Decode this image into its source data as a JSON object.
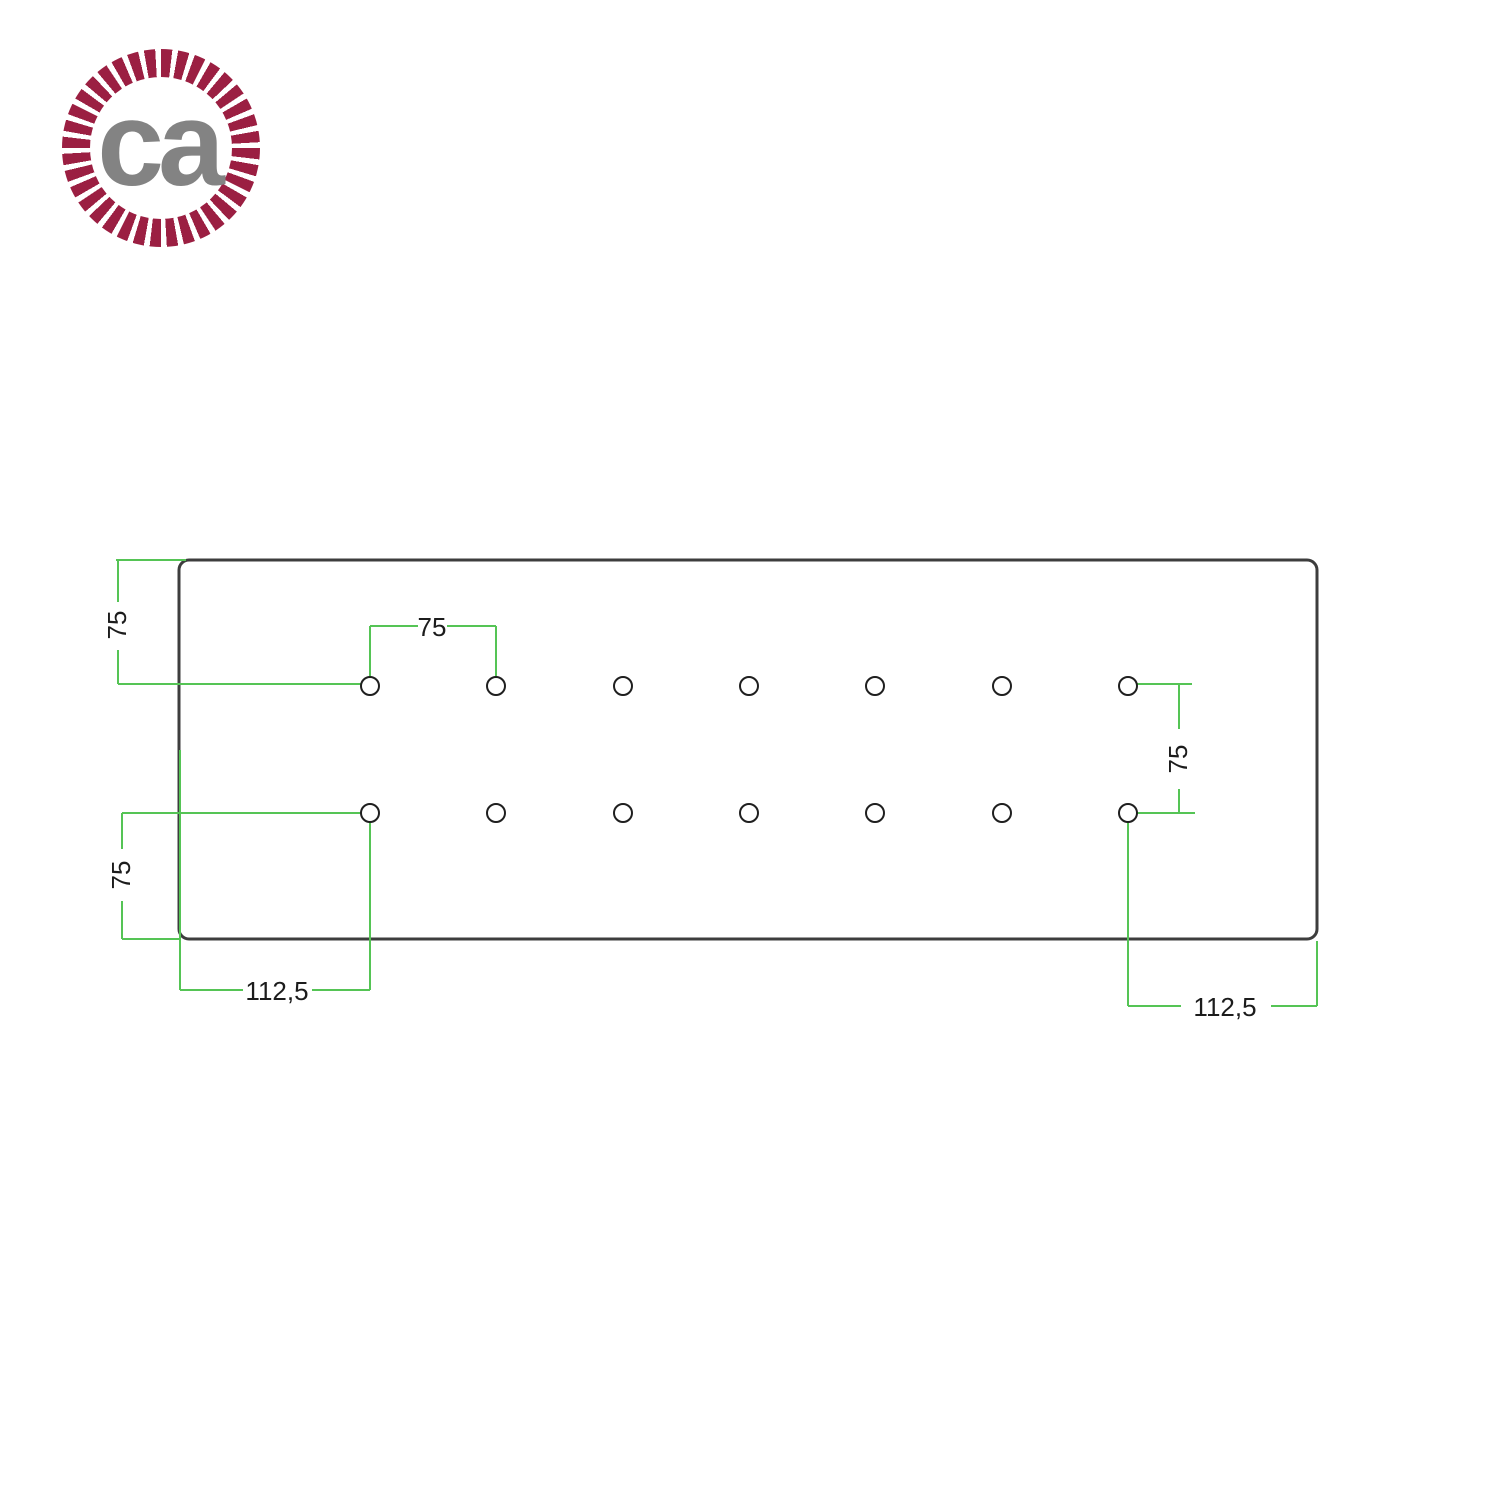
{
  "page": {
    "background": "#ffffff"
  },
  "logo": {
    "text": "ca",
    "rope_color": "#9b1f42",
    "text_color": "#838383"
  },
  "drawing": {
    "colors": {
      "dimension": "#55c455",
      "plate_outline": "#3d3d3d",
      "hole_outline": "#1f1f1f",
      "label_text": "#1c1c1c"
    },
    "plate": {
      "x": 179,
      "y": 560,
      "width": 1138,
      "height": 379,
      "corner_radius": 10,
      "stroke_width": 3
    },
    "holes": {
      "radius": 9,
      "stroke_width": 2,
      "rows_y": [
        686,
        813
      ],
      "cols_x": [
        370,
        496,
        623,
        749,
        875,
        1002,
        1128
      ]
    },
    "dimension_lines": [
      {
        "x1": 116,
        "y1": 560,
        "x2": 186,
        "y2": 560
      },
      {
        "x1": 118,
        "y1": 560,
        "x2": 118,
        "y2": 602
      },
      {
        "x1": 118,
        "y1": 650,
        "x2": 118,
        "y2": 684
      },
      {
        "x1": 118,
        "y1": 684,
        "x2": 361,
        "y2": 684
      },
      {
        "x1": 370,
        "y1": 626,
        "x2": 418,
        "y2": 626
      },
      {
        "x1": 447,
        "y1": 626,
        "x2": 496,
        "y2": 626
      },
      {
        "x1": 370,
        "y1": 626,
        "x2": 370,
        "y2": 677
      },
      {
        "x1": 496,
        "y1": 626,
        "x2": 496,
        "y2": 677
      },
      {
        "x1": 1137,
        "y1": 684,
        "x2": 1192,
        "y2": 684
      },
      {
        "x1": 1179,
        "y1": 684,
        "x2": 1179,
        "y2": 729
      },
      {
        "x1": 1179,
        "y1": 789,
        "x2": 1179,
        "y2": 813
      },
      {
        "x1": 1133,
        "y1": 813,
        "x2": 1195,
        "y2": 813
      },
      {
        "x1": 122,
        "y1": 813,
        "x2": 361,
        "y2": 813
      },
      {
        "x1": 122,
        "y1": 813,
        "x2": 122,
        "y2": 849
      },
      {
        "x1": 122,
        "y1": 901,
        "x2": 122,
        "y2": 939
      },
      {
        "x1": 122,
        "y1": 939,
        "x2": 180,
        "y2": 939
      },
      {
        "x1": 180,
        "y1": 750,
        "x2": 180,
        "y2": 990
      },
      {
        "x1": 370,
        "y1": 822,
        "x2": 370,
        "y2": 990
      },
      {
        "x1": 180,
        "y1": 990,
        "x2": 243,
        "y2": 990
      },
      {
        "x1": 312,
        "y1": 990,
        "x2": 370,
        "y2": 990
      },
      {
        "x1": 1128,
        "y1": 822,
        "x2": 1128,
        "y2": 1006
      },
      {
        "x1": 1317,
        "y1": 941,
        "x2": 1317,
        "y2": 1006
      },
      {
        "x1": 1128,
        "y1": 1006,
        "x2": 1181,
        "y2": 1006
      },
      {
        "x1": 1271,
        "y1": 1006,
        "x2": 1317,
        "y2": 1006
      }
    ],
    "dimension_labels": [
      {
        "text": "75",
        "x": 117,
        "y": 625,
        "rotate": -90
      },
      {
        "text": "75",
        "x": 432,
        "y": 627,
        "rotate": 0
      },
      {
        "text": "75",
        "x": 1178,
        "y": 759,
        "rotate": -90
      },
      {
        "text": "75",
        "x": 121,
        "y": 875,
        "rotate": -90
      },
      {
        "text": "112,5",
        "x": 277,
        "y": 991,
        "rotate": 0
      },
      {
        "text": "112,5",
        "x": 1225,
        "y": 1007,
        "rotate": 0
      }
    ]
  }
}
